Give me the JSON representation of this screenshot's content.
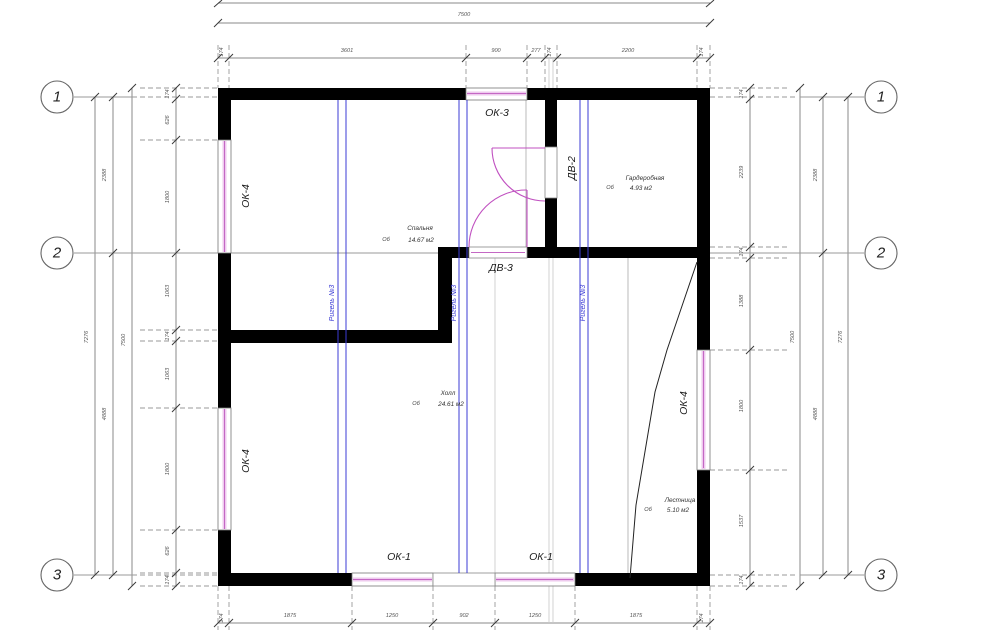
{
  "axes": {
    "rows": [
      {
        "id": "1"
      },
      {
        "id": "2"
      },
      {
        "id": "3"
      }
    ]
  },
  "dims": {
    "overall_width": "7500",
    "top_chain": [
      "174",
      "3601",
      "900",
      "277",
      "174",
      "2200",
      "174"
    ],
    "bottom_chain": [
      "174",
      "1875",
      "1250",
      "902",
      "1250",
      "1875",
      "174"
    ],
    "left_chain": [
      "174",
      "626",
      "1800",
      "1063",
      "174",
      "1063",
      "1800",
      "626",
      "174"
    ],
    "left_spans": [
      "2388",
      "4888"
    ],
    "left_overall": "7500",
    "left_axis_total": "7276",
    "right_chain": [
      "174",
      "2239",
      "174",
      "1388",
      "1800",
      "1537",
      "174"
    ],
    "right_spans": [
      "2388",
      "4888"
    ],
    "right_overall": "7500",
    "right_axis_total": "7276"
  },
  "rooms": [
    {
      "marker": "Об",
      "name": "Спальня",
      "area": "14.67 м2"
    },
    {
      "marker": "Об",
      "name": "Гардеробная",
      "area": "4.93 м2"
    },
    {
      "marker": "Об",
      "name": "Холл",
      "area": "24.61 м2"
    },
    {
      "marker": "Об",
      "name": "Лестница",
      "area": "5.10 м2"
    }
  ],
  "openings": {
    "window_ok4": "ОК-4",
    "window_ok3": "ОК-3",
    "window_ok1": "ОК-1",
    "door_dv2": "ДВ-2",
    "door_dv3": "ДВ-3"
  },
  "beams": {
    "label": "Ригель №3"
  },
  "colors": {
    "wall": "#000000",
    "window_hatch": "#c468c4",
    "beam": "#3b3bd4",
    "door_arc": "#c050c0",
    "dimension": "#8a8a8a"
  }
}
